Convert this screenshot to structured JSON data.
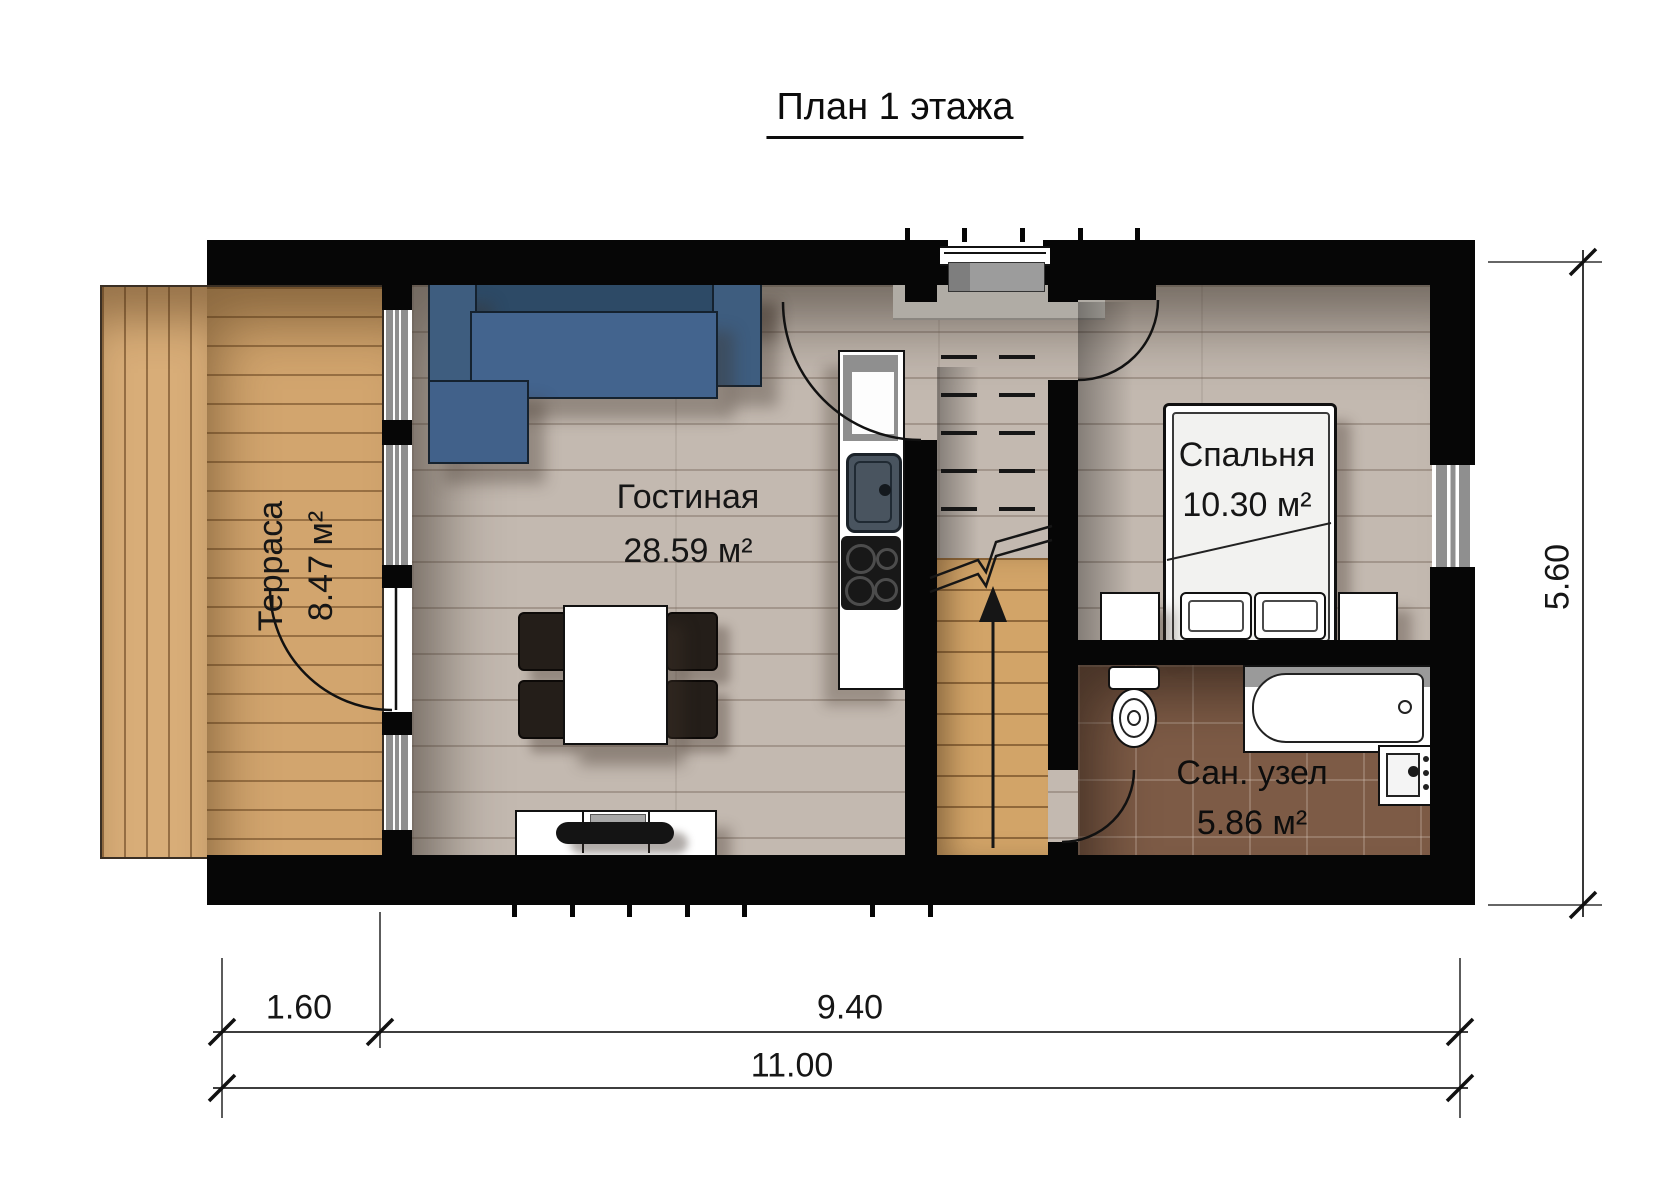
{
  "title": {
    "text": "План 1 этажа"
  },
  "rooms": {
    "terrace": {
      "name": "Терраса",
      "area": "8.47 м²"
    },
    "living": {
      "name": "Гостиная",
      "area": "28.59 м²"
    },
    "bedroom": {
      "name": "Спальня",
      "area": "10.30 м²"
    },
    "bathroom": {
      "name": "Сан. узел",
      "area": "5.86 м²"
    }
  },
  "dimensions": {
    "terrace_width": "1.60",
    "house_width": "9.40",
    "total_width": "11.00",
    "depth": "5.60"
  },
  "colors": {
    "wall": "#060606",
    "floor_wood": "#c3b9b0",
    "terrace_wood": "#d2a56e",
    "bathroom_tile": "#7d5b46",
    "sofa_blue": "#3e5d7f"
  }
}
